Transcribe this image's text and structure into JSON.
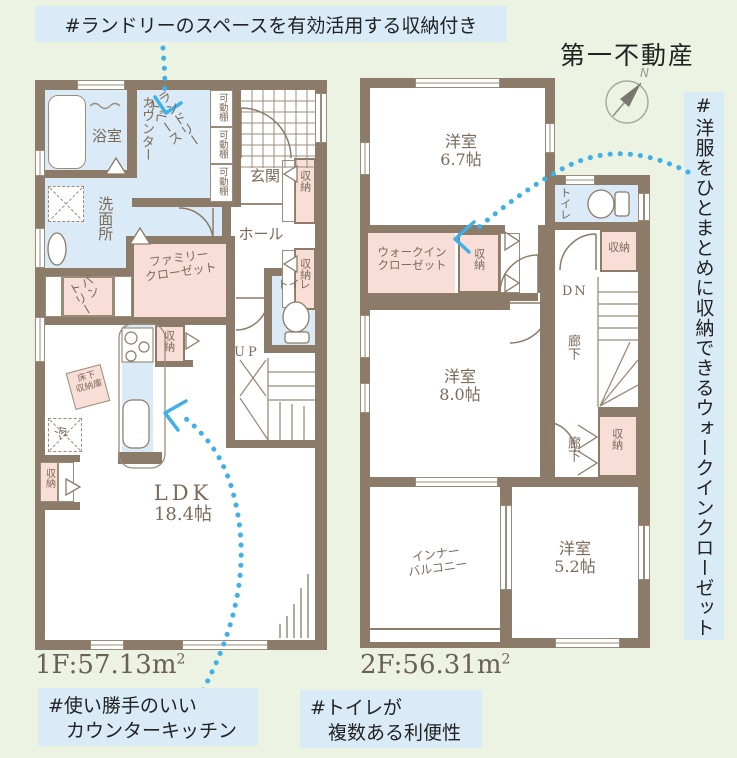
{
  "palette": {
    "bg": "#edf3e2",
    "wall": "#8b7b68",
    "blue_room": "#daeaf6",
    "pink_room": "#f9ded8",
    "tag_bg": "#d9ebf7",
    "accent_blue": "#3fb0e8",
    "text_dark": "#222222",
    "text_brown": "#7b6a58",
    "area_text": "#6b6152",
    "line": "#9b8c79"
  },
  "header": {
    "company": "第一不動産",
    "compass_n": "N"
  },
  "tags": {
    "laundry": "#ランドリーのスペースを有効活用する収納付き",
    "wic": "#洋服をひとまとめに収納できるウォークインクローゼット",
    "kitchen": [
      "#使い勝手のいい",
      "カウンターキッチン"
    ],
    "toilet": [
      "#トイレが",
      "複数ある利便性"
    ]
  },
  "floor1": {
    "area_value": "1F:57.13m",
    "area_sup": "2",
    "labels": {
      "bath": "浴室",
      "counter": "カウンター",
      "laundry": [
        "ランドリー",
        "スペース"
      ],
      "shelf": "可動棚",
      "entrance": "玄関",
      "hall": "ホール",
      "storage": "収納",
      "washroom": "洗面所",
      "pantry": [
        "パン",
        "トリー"
      ],
      "family_closet": [
        "ファミリー",
        "クローゼット"
      ],
      "toilet": "トイレ",
      "up": "UP",
      "underfloor": [
        "床下",
        "収納庫"
      ],
      "fridge": "冷",
      "ldk": [
        "LDK",
        "18.4帖"
      ]
    }
  },
  "floor2": {
    "area_value": "2F:56.31m",
    "area_sup": "2",
    "labels": {
      "bed67": [
        "洋室",
        "6.7帖"
      ],
      "wic": [
        "ウォークイン",
        "クローゼット"
      ],
      "storage": "収納",
      "toilet": "トイレ",
      "dn": "DN",
      "corridor": "廊下",
      "bed80": [
        "洋室",
        "8.0帖"
      ],
      "balcony": [
        "インナー",
        "バルコニー"
      ],
      "bed52": [
        "洋室",
        "5.2帖"
      ]
    }
  }
}
